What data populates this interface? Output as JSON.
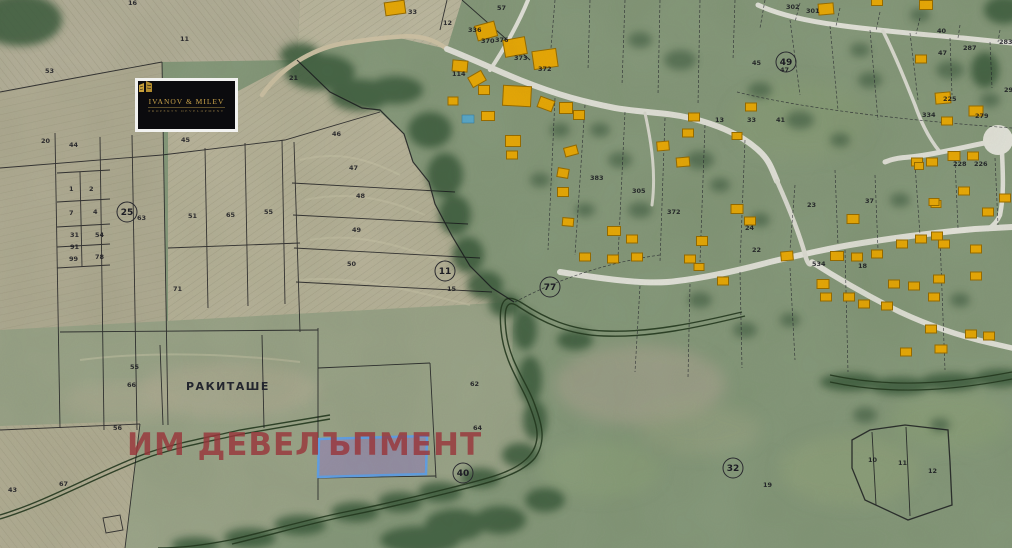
{
  "branding": {
    "logo_title": "IVANOV & MILEV",
    "logo_subtitle": "PROPERTY DEVELOPMENT",
    "logo_icon": "building-towers-icon"
  },
  "map": {
    "locality_label": "РАКИТАШЕ",
    "watermark": "ИМ ДЕВЕЛЪПМЕНТ",
    "colors": {
      "building_fill": "#eaa907",
      "building_stroke": "#9a6d00",
      "highlight_fill": "rgba(148,124,196,0.5)",
      "highlight_stroke": "#63a1e8",
      "watermark_color": "rgba(152,54,58,0.82)"
    },
    "highlight_parcel": {
      "x": 319,
      "y": 437,
      "w": 107,
      "h": 39
    },
    "pool": {
      "x": 468,
      "y": 119
    },
    "parcel_labels": [
      {
        "t": "53",
        "x": 45,
        "y": 73
      },
      {
        "t": "16",
        "x": 128,
        "y": 5
      },
      {
        "t": "11",
        "x": 180,
        "y": 41
      },
      {
        "t": "21",
        "x": 289,
        "y": 80
      },
      {
        "t": "57",
        "x": 497,
        "y": 10
      },
      {
        "t": "20",
        "x": 41,
        "y": 143
      },
      {
        "t": "44",
        "x": 69,
        "y": 147
      },
      {
        "t": "45",
        "x": 181,
        "y": 142
      },
      {
        "t": "1",
        "x": 69,
        "y": 191
      },
      {
        "t": "2",
        "x": 89,
        "y": 191
      },
      {
        "t": "7",
        "x": 69,
        "y": 215
      },
      {
        "t": "4",
        "x": 93,
        "y": 214
      },
      {
        "t": "31",
        "x": 70,
        "y": 237
      },
      {
        "t": "54",
        "x": 95,
        "y": 237
      },
      {
        "t": "91",
        "x": 70,
        "y": 249
      },
      {
        "t": "99",
        "x": 69,
        "y": 261
      },
      {
        "t": "78",
        "x": 95,
        "y": 259
      },
      {
        "t": "63",
        "x": 137,
        "y": 220
      },
      {
        "t": "51",
        "x": 188,
        "y": 218
      },
      {
        "t": "65",
        "x": 226,
        "y": 217
      },
      {
        "t": "55",
        "x": 264,
        "y": 214
      },
      {
        "t": "71",
        "x": 173,
        "y": 291
      },
      {
        "t": "46",
        "x": 332,
        "y": 136
      },
      {
        "t": "47",
        "x": 349,
        "y": 170
      },
      {
        "t": "48",
        "x": 356,
        "y": 198
      },
      {
        "t": "49",
        "x": 352,
        "y": 232
      },
      {
        "t": "50",
        "x": 347,
        "y": 266
      },
      {
        "t": "15",
        "x": 447,
        "y": 291
      },
      {
        "t": "62",
        "x": 470,
        "y": 386
      },
      {
        "t": "64",
        "x": 473,
        "y": 430
      },
      {
        "t": "55",
        "x": 130,
        "y": 369
      },
      {
        "t": "66",
        "x": 127,
        "y": 387
      },
      {
        "t": "56",
        "x": 113,
        "y": 430
      },
      {
        "t": "67",
        "x": 59,
        "y": 486
      },
      {
        "t": "43",
        "x": 8,
        "y": 492
      },
      {
        "t": "33",
        "x": 408,
        "y": 14
      },
      {
        "t": "12",
        "x": 443,
        "y": 25
      },
      {
        "t": "336",
        "x": 468,
        "y": 32
      },
      {
        "t": "370",
        "x": 481,
        "y": 43
      },
      {
        "t": "376",
        "x": 495,
        "y": 42
      },
      {
        "t": "373",
        "x": 514,
        "y": 60
      },
      {
        "t": "372",
        "x": 538,
        "y": 71
      },
      {
        "t": "114",
        "x": 452,
        "y": 76
      },
      {
        "t": "383",
        "x": 590,
        "y": 180
      },
      {
        "t": "305",
        "x": 632,
        "y": 193
      },
      {
        "t": "372",
        "x": 667,
        "y": 214
      },
      {
        "t": "24",
        "x": 745,
        "y": 230
      },
      {
        "t": "22",
        "x": 752,
        "y": 252
      },
      {
        "t": "23",
        "x": 807,
        "y": 207
      },
      {
        "t": "37",
        "x": 865,
        "y": 203
      },
      {
        "t": "534",
        "x": 812,
        "y": 266
      },
      {
        "t": "18",
        "x": 858,
        "y": 268
      },
      {
        "t": "225",
        "x": 943,
        "y": 101
      },
      {
        "t": "279",
        "x": 975,
        "y": 118
      },
      {
        "t": "334",
        "x": 922,
        "y": 117
      },
      {
        "t": "228",
        "x": 953,
        "y": 166
      },
      {
        "t": "226",
        "x": 974,
        "y": 166
      },
      {
        "t": "294",
        "x": 1004,
        "y": 92
      },
      {
        "t": "287",
        "x": 963,
        "y": 50
      },
      {
        "t": "47",
        "x": 938,
        "y": 55
      },
      {
        "t": "283",
        "x": 999,
        "y": 44
      },
      {
        "t": "302",
        "x": 786,
        "y": 9
      },
      {
        "t": "301",
        "x": 806,
        "y": 13
      },
      {
        "t": "45",
        "x": 752,
        "y": 65
      },
      {
        "t": "47",
        "x": 780,
        "y": 72
      },
      {
        "t": "33",
        "x": 747,
        "y": 122
      },
      {
        "t": "41",
        "x": 776,
        "y": 122
      },
      {
        "t": "13",
        "x": 715,
        "y": 122
      },
      {
        "t": "40",
        "x": 937,
        "y": 33
      },
      {
        "t": "10",
        "x": 868,
        "y": 462
      },
      {
        "t": "11",
        "x": 898,
        "y": 465
      },
      {
        "t": "12",
        "x": 928,
        "y": 473
      },
      {
        "t": "19",
        "x": 763,
        "y": 487
      }
    ],
    "circled_labels": [
      {
        "t": "25",
        "x": 127,
        "y": 212
      },
      {
        "t": "11",
        "x": 445,
        "y": 271
      },
      {
        "t": "77",
        "x": 550,
        "y": 287
      },
      {
        "t": "49",
        "x": 786,
        "y": 62
      },
      {
        "t": "32",
        "x": 733,
        "y": 468
      },
      {
        "t": "40",
        "x": 463,
        "y": 473
      }
    ],
    "buildings": [
      [
        395,
        8,
        20,
        13,
        -8
      ],
      [
        486,
        31,
        20,
        15,
        -15
      ],
      [
        515,
        47,
        22,
        17,
        -10
      ],
      [
        545,
        59,
        24,
        18,
        -8
      ],
      [
        460,
        66,
        15,
        11,
        5
      ],
      [
        477,
        79,
        15,
        11,
        -30
      ],
      [
        484,
        90,
        11,
        9,
        0
      ],
      [
        453,
        101,
        10,
        8,
        0
      ],
      [
        517,
        96,
        28,
        20,
        3
      ],
      [
        488,
        116,
        13,
        9,
        0
      ],
      [
        546,
        104,
        15,
        11,
        20
      ],
      [
        566,
        108,
        13,
        11,
        0
      ],
      [
        579,
        115,
        11,
        9,
        0
      ],
      [
        513,
        141,
        15,
        11,
        0
      ],
      [
        571,
        151,
        13,
        9,
        -15
      ],
      [
        512,
        155,
        11,
        8,
        0
      ],
      [
        563,
        173,
        11,
        9,
        10
      ],
      [
        563,
        192,
        11,
        9,
        0
      ],
      [
        568,
        222,
        11,
        8,
        5
      ],
      [
        614,
        231,
        13,
        9,
        0
      ],
      [
        632,
        239,
        11,
        8,
        0
      ],
      [
        585,
        257,
        11,
        8,
        0
      ],
      [
        613,
        259,
        11,
        8,
        0
      ],
      [
        637,
        257,
        11,
        8,
        0
      ],
      [
        683,
        162,
        13,
        9,
        -5
      ],
      [
        737,
        209,
        12,
        9,
        0
      ],
      [
        750,
        221,
        11,
        8,
        0
      ],
      [
        702,
        241,
        11,
        9,
        0
      ],
      [
        690,
        259,
        11,
        8,
        0
      ],
      [
        699,
        267,
        10,
        7,
        0
      ],
      [
        723,
        281,
        11,
        8,
        0
      ],
      [
        787,
        256,
        12,
        9,
        -5
      ],
      [
        853,
        219,
        12,
        9,
        0
      ],
      [
        837,
        256,
        13,
        9,
        0
      ],
      [
        857,
        257,
        11,
        8,
        0
      ],
      [
        877,
        254,
        11,
        8,
        0
      ],
      [
        823,
        284,
        12,
        9,
        0
      ],
      [
        826,
        297,
        11,
        8,
        0
      ],
      [
        849,
        297,
        11,
        8,
        0
      ],
      [
        864,
        304,
        11,
        8,
        0
      ],
      [
        887,
        306,
        11,
        8,
        0
      ],
      [
        902,
        244,
        11,
        8,
        0
      ],
      [
        921,
        239,
        11,
        8,
        0
      ],
      [
        937,
        236,
        11,
        8,
        0
      ],
      [
        917,
        162,
        11,
        8,
        0
      ],
      [
        932,
        162,
        11,
        8,
        0
      ],
      [
        964,
        191,
        11,
        8,
        0
      ],
      [
        988,
        212,
        11,
        8,
        0
      ],
      [
        936,
        204,
        10,
        7,
        0
      ],
      [
        944,
        244,
        11,
        8,
        0
      ],
      [
        976,
        249,
        11,
        8,
        0
      ],
      [
        976,
        276,
        11,
        8,
        0
      ],
      [
        914,
        286,
        11,
        8,
        0
      ],
      [
        939,
        279,
        11,
        8,
        0
      ],
      [
        934,
        297,
        11,
        8,
        0
      ],
      [
        894,
        284,
        11,
        8,
        0
      ],
      [
        971,
        334,
        11,
        8,
        0
      ],
      [
        931,
        329,
        11,
        8,
        0
      ],
      [
        989,
        336,
        11,
        8,
        0
      ],
      [
        826,
        9,
        15,
        11,
        -5
      ],
      [
        926,
        5,
        13,
        9,
        0
      ],
      [
        877,
        2,
        11,
        7,
        0
      ],
      [
        751,
        107,
        11,
        8,
        0
      ],
      [
        737,
        136,
        10,
        7,
        0
      ],
      [
        663,
        146,
        12,
        9,
        -5
      ],
      [
        688,
        133,
        11,
        8,
        0
      ],
      [
        694,
        117,
        11,
        8,
        0
      ],
      [
        943,
        98,
        15,
        11,
        -5
      ],
      [
        976,
        111,
        14,
        10,
        0
      ],
      [
        947,
        121,
        11,
        8,
        0
      ],
      [
        921,
        59,
        11,
        8,
        0
      ],
      [
        954,
        156,
        12,
        9,
        0
      ],
      [
        973,
        156,
        11,
        8,
        0
      ],
      [
        919,
        166,
        9,
        7,
        0
      ],
      [
        934,
        202,
        10,
        7,
        0
      ],
      [
        1005,
        198,
        11,
        8,
        0
      ],
      [
        906,
        352,
        11,
        8,
        0
      ],
      [
        941,
        349,
        12,
        8,
        0
      ]
    ]
  }
}
